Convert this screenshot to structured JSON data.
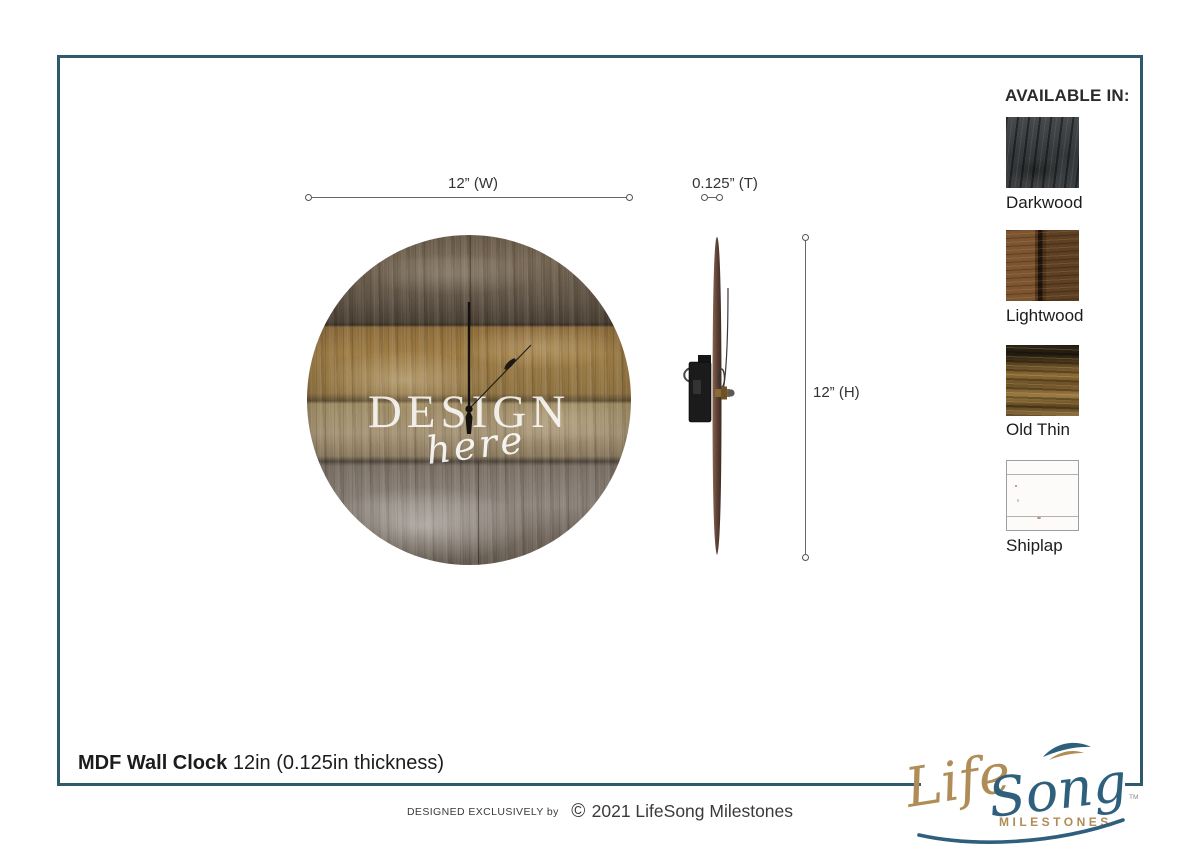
{
  "page": {
    "background": "#ffffff",
    "frame_color": "#2f5a6e"
  },
  "dimensions": {
    "width_label": "12” (W)",
    "thickness_label": "0.125” (T)",
    "height_label": "12” (H)"
  },
  "clock": {
    "design_text": "DESIGN",
    "here_text": "here"
  },
  "available": {
    "header": "AVAILABLE IN:",
    "swatches": [
      {
        "name": "Darkwood"
      },
      {
        "name": "Lightwood"
      },
      {
        "name": "Old Thin"
      },
      {
        "name": "Shiplap"
      }
    ]
  },
  "footer": {
    "product_title_bold": "MDF Wall Clock",
    "product_title_rest": " 12in (0.125in thickness)",
    "credit_small": "DESIGNED EXCLUSIVELY by",
    "copyright_symbol": "©",
    "credit_large": "2021 LifeSong Milestones"
  },
  "logo": {
    "life": "Life",
    "song": "Song",
    "milestones": "MILESTONES",
    "tm": "TM",
    "gold": "#b08d57",
    "blue": "#2e5f7d"
  }
}
